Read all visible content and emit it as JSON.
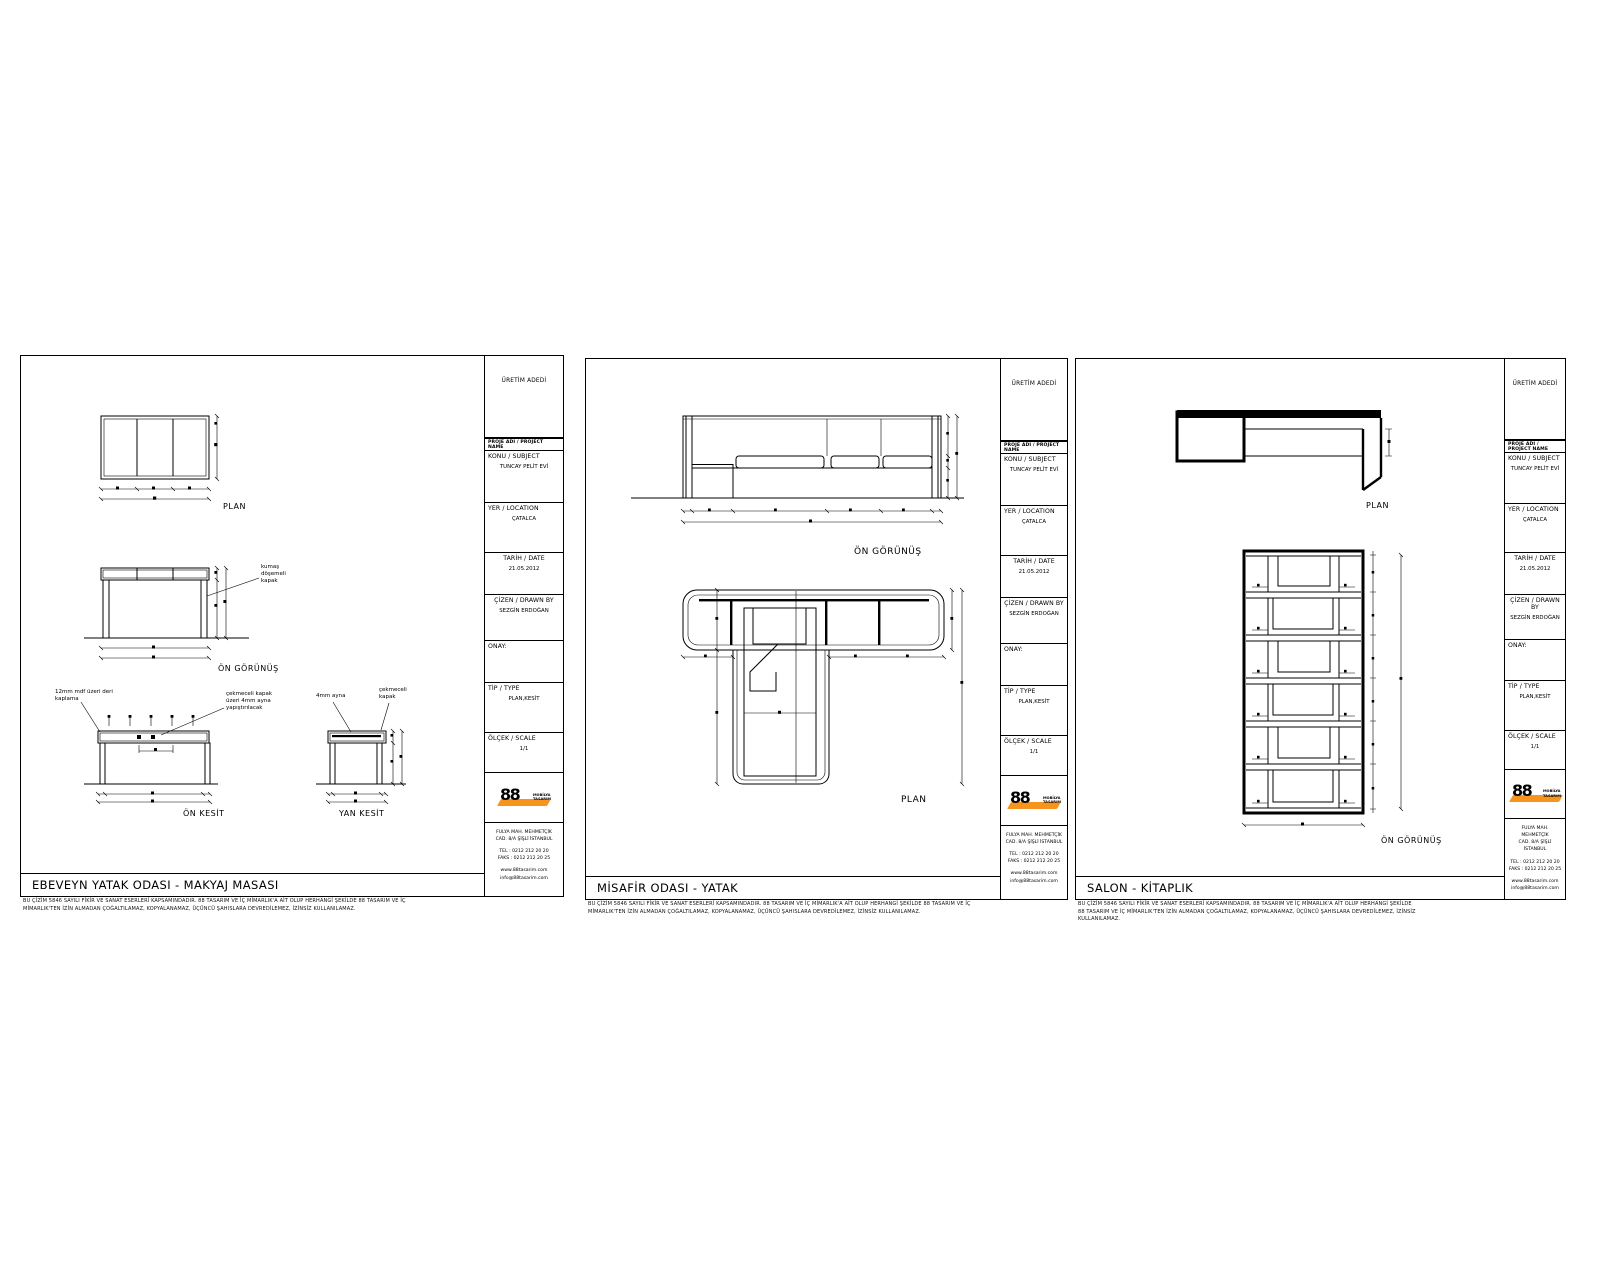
{
  "colors": {
    "line": "#000000",
    "accent_orange": "#F7941D",
    "paper": "#ffffff"
  },
  "titleblock": {
    "production_note": "ÜRETİM ADEDİ",
    "project_name_header": "PROJE ADI / PROJECT NAME",
    "konu_label": "KONU / SUBJECT",
    "konu_value": "TUNCAY PELİT EVİ",
    "yer_label": "YER / LOCATION",
    "yer_value": "ÇATALCA",
    "tarih_label": "TARİH / DATE",
    "tarih_value": "21.05.2012",
    "cizen_label": "ÇİZEN / DRAWN BY",
    "cizen_value": "SEZGİN ERDOĞAN",
    "onay_label": "ONAY:",
    "tip_label": "TİP / TYPE",
    "tip_value": "PLAN,KESİT",
    "olcek_label": "ÖLÇEK / SCALE",
    "olcek_value": "1/1",
    "logo": {
      "number": "88",
      "word1": "MOBİLYA",
      "word2": "TASARIM"
    },
    "address": [
      "FULYA MAH. MEHMETÇİK",
      "CAD. 8/A ŞİŞLİ İSTANBUL"
    ],
    "phones": [
      "TEL   : 0212 212 20 20",
      "FAKS : 0212 212 20 25"
    ],
    "web": [
      "www.88tasarim.com",
      "info@88tasarim.com"
    ]
  },
  "sheets": [
    {
      "title": "EBEVEYN YATAK ODASI - MAKYAJ MASASI",
      "labels": {
        "plan": "PLAN",
        "front": "ÖN GÖRÜNÜŞ",
        "on_kesit": "ÖN KESİT",
        "yan_kesit": "YAN KESİT"
      },
      "annotations": {
        "a1": [
          "kumaş",
          "döşemeli",
          "kapak"
        ],
        "a2": [
          "12mm mdf üzeri deri",
          "kaplama"
        ],
        "a3": [
          "çekmeceli kapak",
          "üzeri 4mm ayna",
          "yapıştırılacak"
        ],
        "a4": [
          "4mm ayna"
        ],
        "a5": [
          "çekmeceli",
          "kapak"
        ]
      },
      "disclaimer": [
        "BU ÇİZİM 5846 SAYILI FİKİR VE SANAT ESERLERİ KAPSAMINDADIR. 88 TASARIM VE İÇ MİMARLIK'A AİT OLUP HERHANGİ ŞEKİLDE 88 TASARIM VE İÇ",
        "MİMARLIK'TEN İZİN ALMADAN ÇOĞALTILAMAZ, KOPYALANAMAZ, ÜÇÜNCÜ ŞAHISLARA DEVREDİLEMEZ, İZİNSİZ KULLANILAMAZ."
      ]
    },
    {
      "title": "MİSAFİR ODASI - YATAK",
      "labels": {
        "front": "ÖN GÖRÜNÜŞ",
        "plan": "PLAN"
      },
      "disclaimer": [
        "BU ÇİZİM 5846 SAYILI FİKİR VE SANAT ESERLERİ KAPSAMINDADIR. 88 TASARIM VE İÇ MİMARLIK'A AİT OLUP HERHANGİ ŞEKİLDE 88 TASARIM VE İÇ",
        "MİMARLIK'TEN İZİN ALMADAN ÇOĞALTILAMAZ, KOPYALANAMAZ, ÜÇÜNCÜ ŞAHISLARA DEVREDİLEMEZ, İZİNSİZ KULLANILAMAZ."
      ]
    },
    {
      "title": "SALON - KİTAPLIK",
      "labels": {
        "plan": "PLAN",
        "front": "ÖN GÖRÜNÜŞ"
      },
      "disclaimer": [
        "BU ÇİZİM 5846 SAYILI FİKİR VE SANAT ESERLERİ KAPSAMINDADIR. 88 TASARIM VE İÇ MİMARLIK'A AİT OLUP HERHANGİ ŞEKİLDE",
        "88 TASARIM VE İÇ MİMARLIK'TEN İZİN ALMADAN ÇOĞALTILAMAZ, KOPYALANAMAZ, ÜÇÜNCÜ ŞAHISLARA DEVREDİLEMEZ, İZİNSİZ",
        "KULLANILAMAZ."
      ]
    }
  ]
}
